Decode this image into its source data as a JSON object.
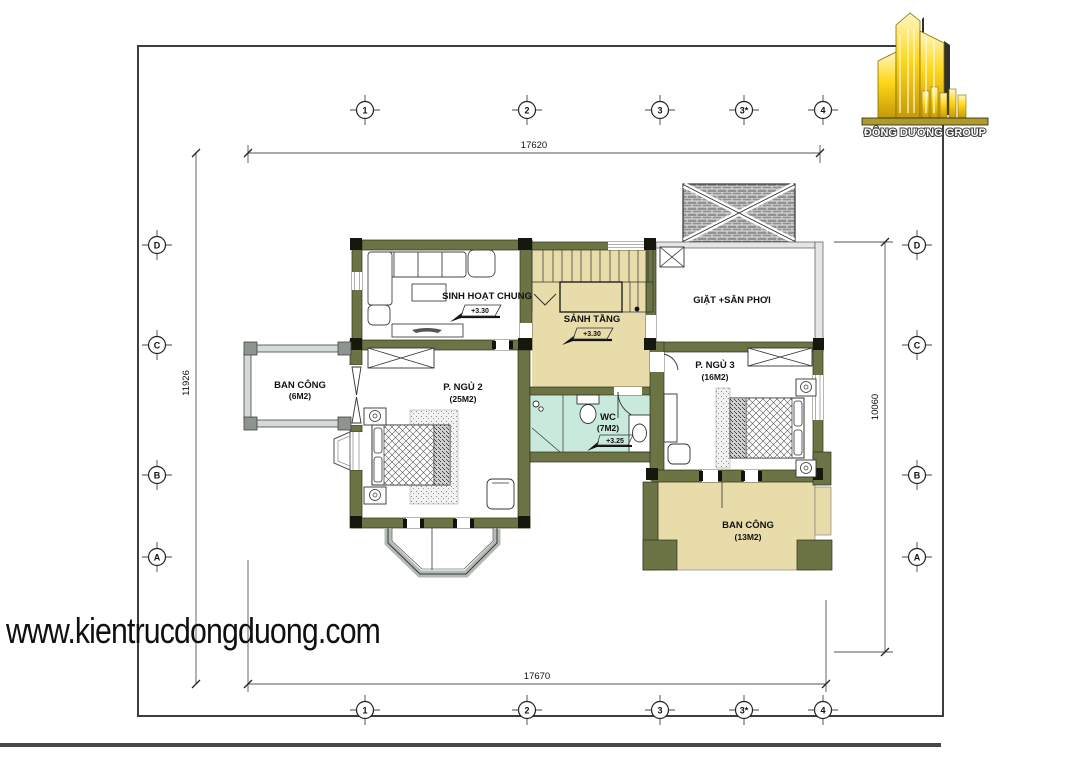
{
  "logo": {
    "company": "ĐÔNG DƯƠNG GROUP"
  },
  "watermark": {
    "url_text": "www.kientrucdongduong.com"
  },
  "grid": {
    "cols": [
      "1",
      "2",
      "3",
      "3*",
      "4"
    ],
    "rows": [
      "D",
      "C",
      "B",
      "A"
    ]
  },
  "dimensions": {
    "top": "17620",
    "bottom": "17670",
    "left": "11926",
    "right": "10060"
  },
  "rooms": {
    "living": {
      "name": "SINH HOẠT CHUNG",
      "level": "+3.30"
    },
    "hall": {
      "name": "SẢNH TẦNG",
      "level": "+3.30"
    },
    "laundry": {
      "name": "GIẶT +SÂN PHƠI"
    },
    "balcony_left": {
      "name": "BAN CÔNG",
      "area": "(6M2)"
    },
    "bedroom2": {
      "name": "P. NGỦ 2",
      "area": "(25M2)"
    },
    "wc": {
      "name": "WC",
      "area": "(7M2)",
      "level": "+3.25"
    },
    "bedroom3": {
      "name": "P. NGỦ 3",
      "area": "(16M2)"
    },
    "balcony_right": {
      "name": "BAN CÔNG",
      "area": "(13M2)"
    }
  },
  "colors": {
    "wall": "#6c7445",
    "hall_fill": "#e9dcab",
    "wc_fill": "#c9e9dc",
    "balcony_fill": "#e9dcab",
    "logo_gold": "#f5c61a"
  }
}
